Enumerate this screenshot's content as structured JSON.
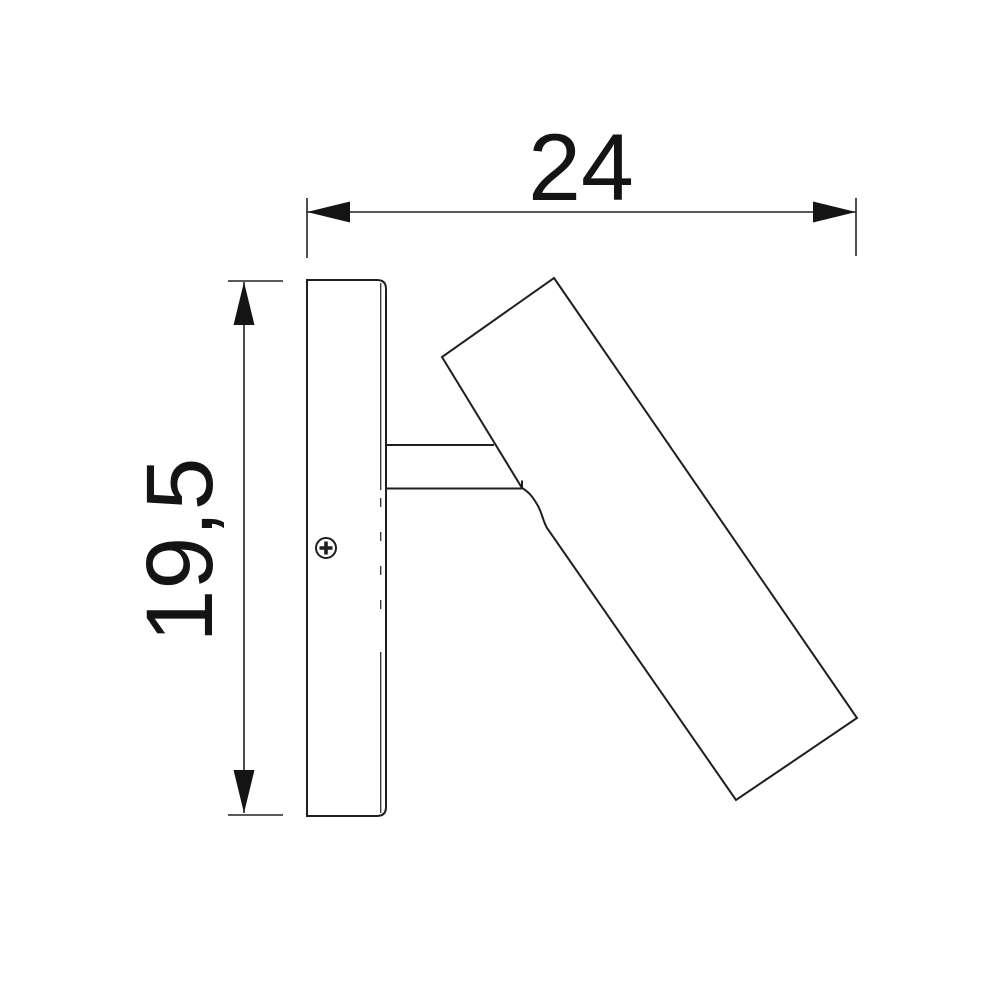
{
  "drawing": {
    "dimension_width": {
      "value": "24"
    },
    "dimension_height": {
      "value": "19,5"
    },
    "screw_icon": "phillips-screw-head",
    "colors": {
      "line": "#1f1f1f",
      "text": "#141414",
      "background": "#ffffff"
    }
  }
}
